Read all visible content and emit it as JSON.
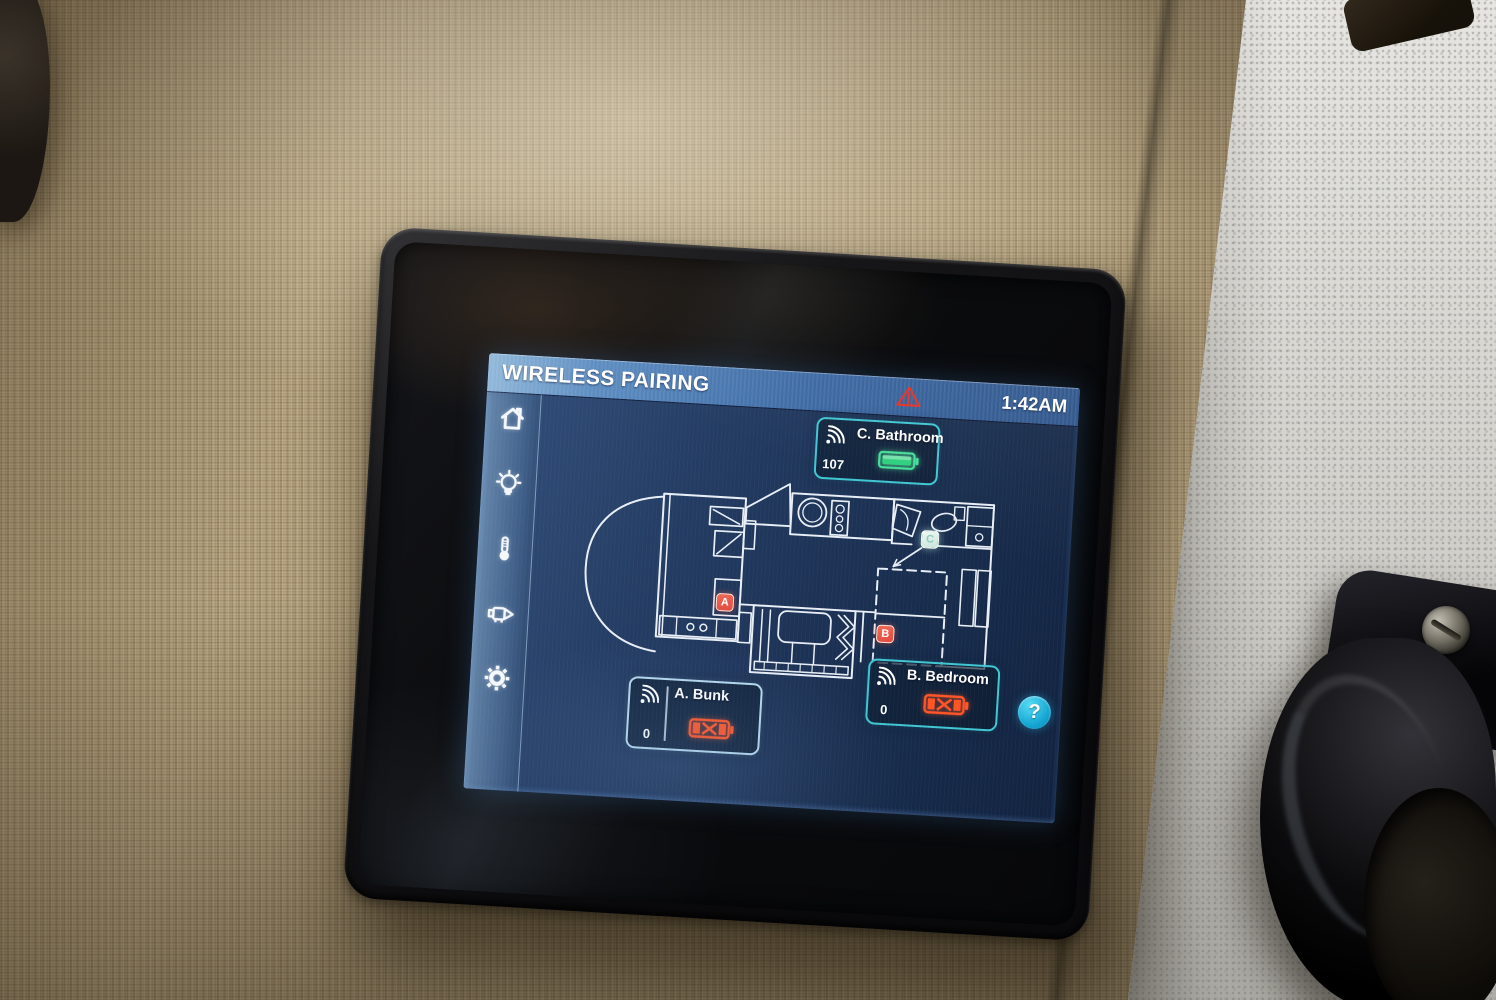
{
  "screen": {
    "header": {
      "title": "WIRELESS PAIRING",
      "time": "1:42AM",
      "warning_icon": "warning-triangle-icon"
    },
    "sidebar": {
      "items": [
        {
          "id": "home",
          "icon": "home-icon"
        },
        {
          "id": "lighting",
          "icon": "lightbulb-icon"
        },
        {
          "id": "climate",
          "icon": "thermometer-icon"
        },
        {
          "id": "pump",
          "icon": "water-pump-icon"
        },
        {
          "id": "settings",
          "icon": "gear-icon"
        }
      ]
    },
    "sensors": [
      {
        "id": "A",
        "label": "A. Bunk",
        "signal": "0",
        "battery_status": "disconnected"
      },
      {
        "id": "B",
        "label": "B. Bedroom",
        "signal": "0",
        "battery_status": "disconnected"
      },
      {
        "id": "C",
        "label": "C. Bathroom",
        "signal": "107",
        "battery_status": "good"
      }
    ],
    "help": {
      "label": "?"
    },
    "floorplan": {
      "type": "rv-motorhome-floorplan",
      "markers": [
        {
          "letter": "A",
          "state": "alert"
        },
        {
          "letter": "B",
          "state": "alert"
        },
        {
          "letter": "C",
          "state": "ok"
        }
      ]
    }
  },
  "theme": {
    "accent-teal": "#3fc6d2",
    "accent-ice": "#b6d9ee",
    "battery-good": "#45e29a",
    "battery-bad": "#ff5526",
    "warning-red": "#e23326",
    "help-cyan": "#17a9d6",
    "marker-red": "#e0493f",
    "marker-ok": "#c8e4da",
    "line-white": "#e8eef6"
  }
}
